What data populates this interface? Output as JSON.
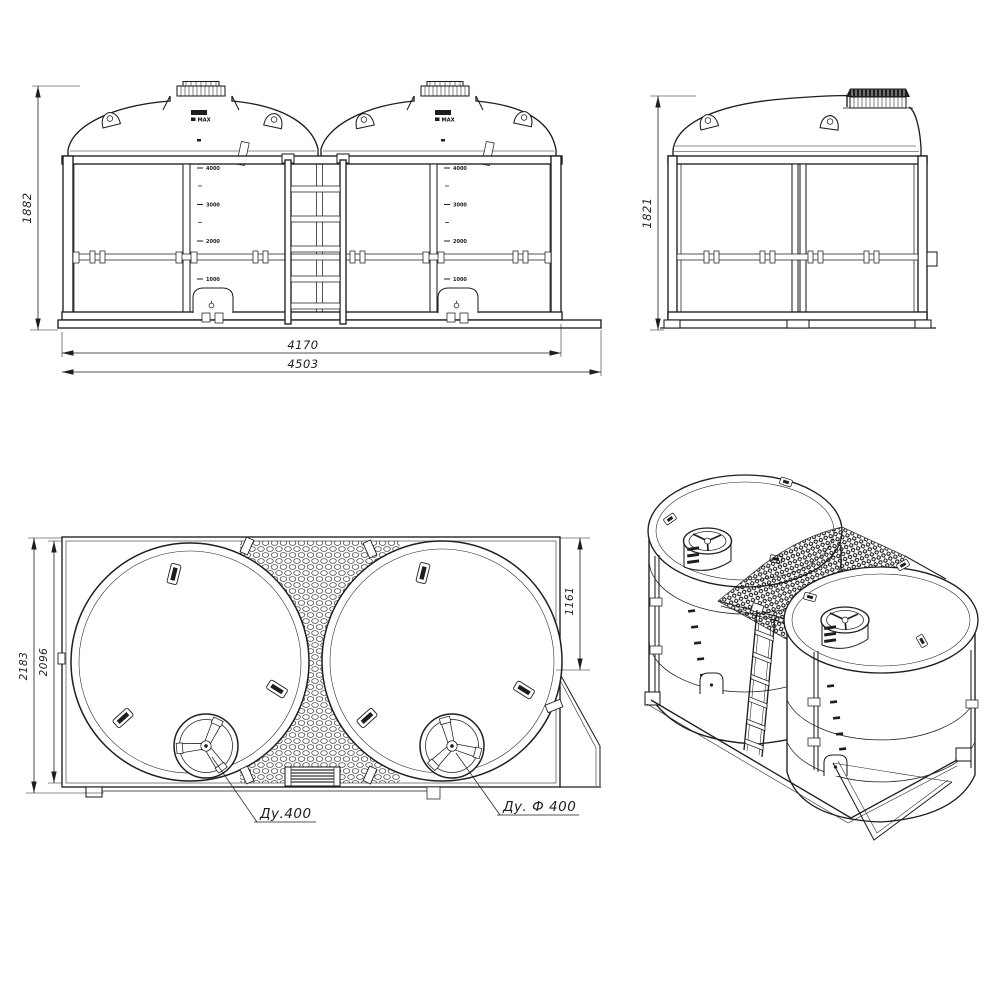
{
  "views": {
    "front": {
      "height_mm": "1882",
      "frame_width_mm": "4170",
      "overall_width_mm": "4503"
    },
    "side": {
      "height_mm": "1821"
    },
    "top": {
      "overall_depth_mm": "2183",
      "frame_depth_mm": "2096",
      "manhole_offset_mm": "1161",
      "left_manhole_callout": "Ду.400",
      "right_manhole_callout": "Ду. Ф 400"
    }
  },
  "tank": {
    "cap_label": "MAX",
    "level_scale_liters": [
      "4000",
      "3000",
      "2000",
      "1000"
    ]
  }
}
